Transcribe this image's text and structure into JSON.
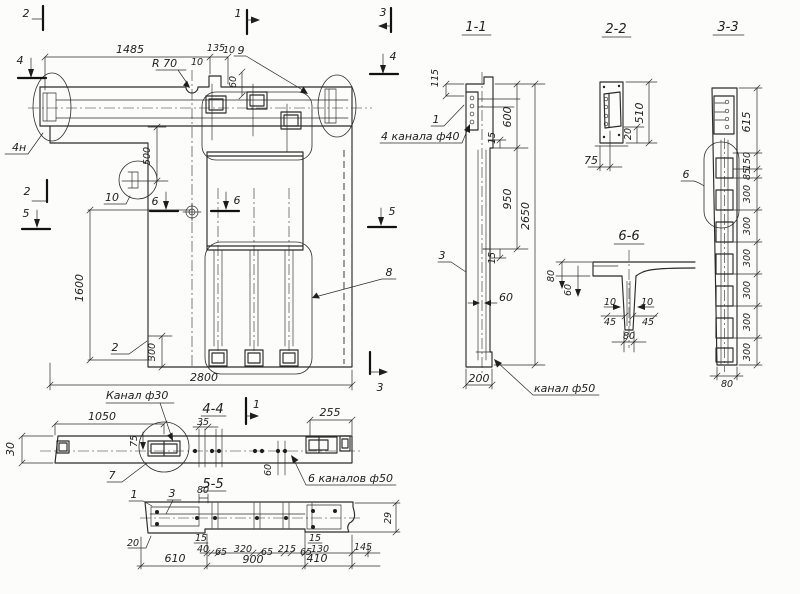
{
  "meta": {
    "doc_type": "precast concrete panel working drawing",
    "paper_color": "#fcfcfb",
    "ink_color": "#1e1e1e"
  },
  "plan": {
    "marks": {
      "m1": "1",
      "m2": "2",
      "m3": "3",
      "m4": "4",
      "m5": "5",
      "m6": "6"
    },
    "dims": {
      "d1485": "1485",
      "r70": "R 70",
      "d135": "135",
      "d10": "10",
      "d60": "60",
      "d500": "500",
      "d1600": "1600",
      "d300": "300",
      "d2800": "2800"
    },
    "pos": {
      "p2": "2",
      "p8": "8",
      "p9": "9",
      "p10": "10",
      "p4n": "4н"
    }
  },
  "strip": {
    "titles": {
      "t44": "4-4",
      "t55": "5-5"
    },
    "dims": {
      "d1050": "1050",
      "d30": "30",
      "d75": "75",
      "d35": "35",
      "d255": "255",
      "d60": "60"
    },
    "pos": {
      "p7": "7",
      "m1": "1"
    },
    "notes": {
      "kanal30": "Канал ф30",
      "kanalov6": "6 каналов ф50"
    }
  },
  "sec55": {
    "pos": {
      "p1": "1",
      "p3": "3"
    },
    "dims": {
      "d80": "80",
      "d29": "29",
      "d20": "20",
      "d15": "15",
      "d40": "40",
      "d65": "65",
      "d320": "320",
      "d215": "215",
      "d130": "130",
      "d145": "145",
      "d610": "610",
      "d900": "900",
      "d410": "410"
    }
  },
  "sec11": {
    "title": "1-1",
    "dims": {
      "d115": "115",
      "d600": "600",
      "d15": "15",
      "d950": "950",
      "d2650": "2650",
      "d60": "60",
      "d200": "200"
    },
    "pos": {
      "p1": "1",
      "p3": "3"
    },
    "notes": {
      "ch40": "4 канала ф40",
      "kanal50": "канал ф50"
    }
  },
  "sec22": {
    "title": "2-2",
    "dims": {
      "d510": "510",
      "d20": "20",
      "d75": "75"
    }
  },
  "sec33": {
    "title": "3-3",
    "dims": {
      "d615": "615",
      "d150": "150",
      "d85": "85",
      "d300": "300",
      "d80": "80"
    },
    "pos": {
      "p6": "6"
    }
  },
  "sec66": {
    "title": "6-6",
    "dims": {
      "d80": "80",
      "d60": "60",
      "d10": "10",
      "d45": "45",
      "d80b": "80"
    }
  }
}
